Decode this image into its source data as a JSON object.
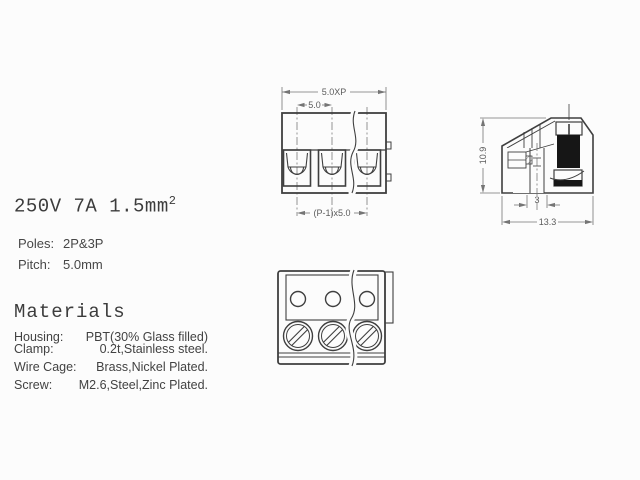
{
  "colors": {
    "background": "#fcfcfc",
    "line": "#3f3f3f",
    "dimension_line": "#757575",
    "dimension_text": "#5c5c5c",
    "body_text": "#3c3c3c",
    "screw_fill": "#161616"
  },
  "specs": {
    "rating_main": "250V 7A 1.5mm",
    "rating_sup": "2",
    "poles_label": "Poles:",
    "poles_value": "2P&3P",
    "pitch_label": "Pitch:",
    "pitch_value": "5.0mm"
  },
  "materials": {
    "heading": "Materials",
    "rows": [
      {
        "label": "Housing:",
        "value": "PBT(30% Glass filled)"
      },
      {
        "label": "Clamp:",
        "value": "0.2t,Stainless steel."
      },
      {
        "label": "Wire Cage:",
        "value": "Brass,Nickel Plated."
      },
      {
        "label": "Screw:",
        "value": "M2.6,Steel,Zinc Plated."
      }
    ]
  },
  "front_view": {
    "dim_total_width": "5.0XP",
    "dim_pitch": "5.0",
    "dim_pole_span": "(P-1)x5.0"
  },
  "side_view": {
    "dim_height": "10.9",
    "dim_pin_width": "3",
    "dim_depth": "13.3"
  }
}
